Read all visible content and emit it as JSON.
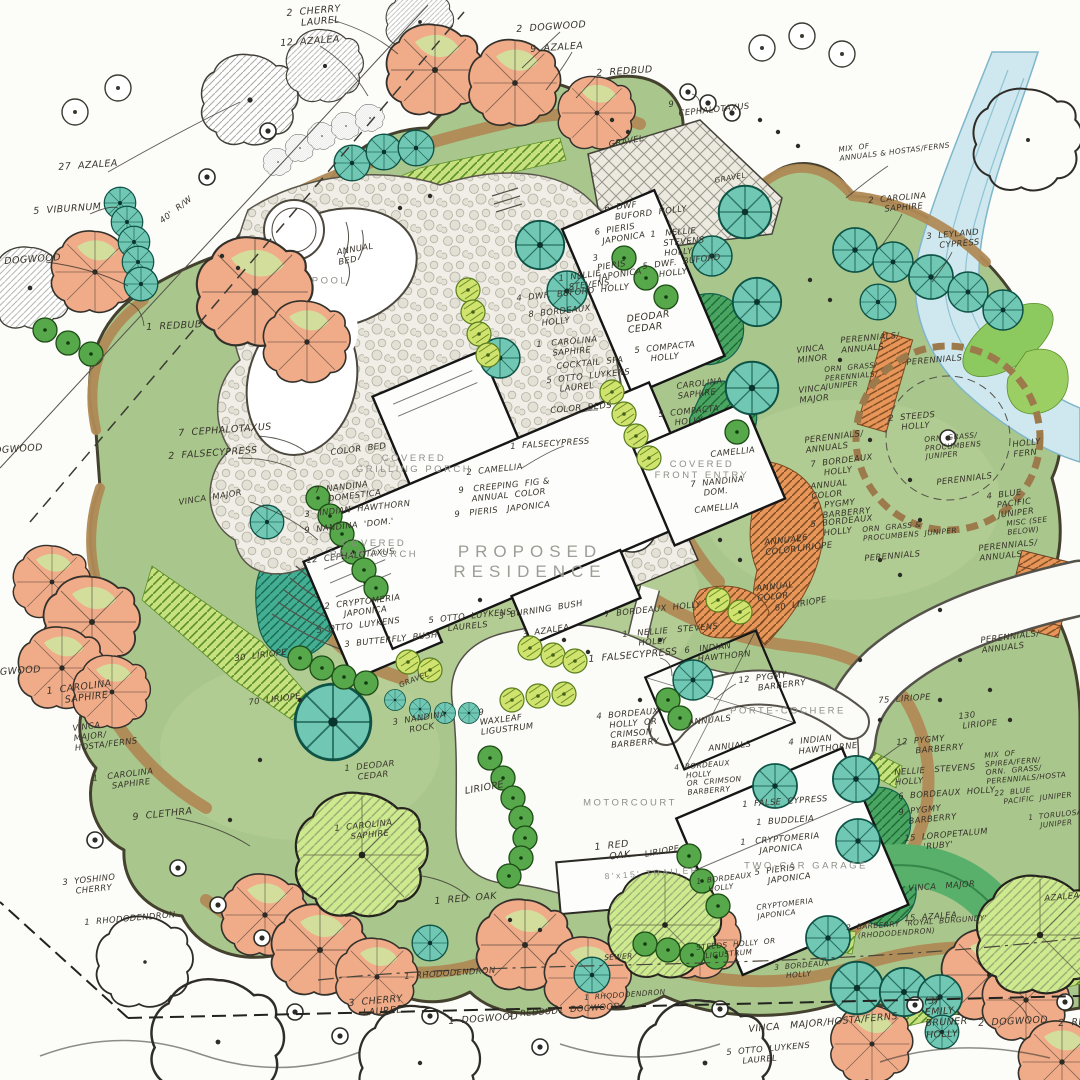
{
  "drawing": {
    "kind": "residential landscape master plan",
    "style": "hand-drawn color rendering"
  },
  "colors": {
    "paper": "#fcfcf9",
    "lawn": "#a9c78d",
    "bed_tan": "#b08a56",
    "evergreen_teal": "#6fc7b4",
    "canopy_salmon": "#f0ab89",
    "shrub_green": "#56a84b",
    "light_green": "#c6e17e",
    "water_blue": "#cfe8ef",
    "pencil": "#37332a",
    "arch_text": "#8f8f88"
  },
  "structure_labels": [
    {
      "t": "POOL",
      "x": 330,
      "y": 281,
      "k": "a"
    },
    {
      "t": "PROPOSED\nRESIDENCE",
      "x": 530,
      "y": 562,
      "k": "A"
    },
    {
      "t": "COVERED\nGRILLING PORCH",
      "x": 414,
      "y": 464,
      "k": "a"
    },
    {
      "t": "COVERED\nREAR PORCH",
      "x": 374,
      "y": 549,
      "k": "a"
    },
    {
      "t": "COVERED\nFRONT ENTRY",
      "x": 702,
      "y": 470,
      "k": "a"
    },
    {
      "t": "MOTORCOURT",
      "x": 630,
      "y": 803,
      "k": "a"
    },
    {
      "t": "PORTE-COCHERE",
      "x": 788,
      "y": 711,
      "k": "a"
    },
    {
      "t": "TWO-CAR GARAGE",
      "x": 806,
      "y": 866,
      "k": "a"
    },
    {
      "t": "8'x15' TRAILER",
      "x": 652,
      "y": 873,
      "k": "a8",
      "r": -4
    }
  ],
  "plant_labels": [
    {
      "t": "2  CHERRY\n    LAUREL",
      "x": 286,
      "y": 8,
      "r": -5
    },
    {
      "t": "12  AZALEA",
      "x": 280,
      "y": 38,
      "r": -4
    },
    {
      "t": "2  DOGWOOD",
      "x": 516,
      "y": 24,
      "r": -4
    },
    {
      "t": "9  AZALEA",
      "x": 530,
      "y": 44,
      "r": -4
    },
    {
      "t": "2  REDBUD",
      "x": 596,
      "y": 68,
      "r": -4
    },
    {
      "t": "9\n   CEPHALOTAXUS",
      "x": 668,
      "y": 100,
      "r": -6,
      "k": "h8"
    },
    {
      "t": "GRAVEL",
      "x": 608,
      "y": 140,
      "r": -10,
      "k": "h8"
    },
    {
      "t": "GRAVEL",
      "x": 714,
      "y": 177,
      "r": -10,
      "k": "h7"
    },
    {
      "t": "MIX  OF\nANNUALS & HOSTAS/FERNS",
      "x": 838,
      "y": 146,
      "r": -7,
      "k": "h7"
    },
    {
      "t": "2  CAROLINA\n     SAPHIRE",
      "x": 868,
      "y": 196,
      "r": -5,
      "k": "h8"
    },
    {
      "t": "3  LEYLAND\n    CYPRESS",
      "x": 926,
      "y": 232,
      "r": -5,
      "k": "h8"
    },
    {
      "t": "27  AZALEA",
      "x": 58,
      "y": 162,
      "r": -4
    },
    {
      "t": "5  VIBURNUM",
      "x": 33,
      "y": 206,
      "r": -4
    },
    {
      "t": "40'  R/W",
      "x": 158,
      "y": 218,
      "r": -38,
      "k": "h8"
    },
    {
      "t": "DOGWOOD",
      "x": 4,
      "y": 256,
      "r": -4
    },
    {
      "t": "1  REDBUD",
      "x": 146,
      "y": 322,
      "r": -3
    },
    {
      "t": "ANNUAL\nBED",
      "x": 336,
      "y": 248,
      "r": -10,
      "k": "h8"
    },
    {
      "t": "6  DWF\n   BUFORD  HOLLY",
      "x": 604,
      "y": 204,
      "r": -7,
      "k": "h8"
    },
    {
      "t": "6  PIERIS\n  JAPONICA",
      "x": 594,
      "y": 228,
      "r": -9,
      "k": "h8"
    },
    {
      "t": "1   NELLIE\n    STEVENS\n    HOLLY",
      "x": 650,
      "y": 230,
      "r": -5,
      "k": "h8"
    },
    {
      "t": "3\n PIERIS\n JAPONICA",
      "x": 592,
      "y": 254,
      "r": -9,
      "k": "h8"
    },
    {
      "t": "5  DWF.  BUFORD\n     HOLLY",
      "x": 642,
      "y": 262,
      "r": -7,
      "k": "h8"
    },
    {
      "t": "1  NELLIE\n   STEVENS",
      "x": 558,
      "y": 274,
      "r": -7,
      "k": "h8"
    },
    {
      "t": "4  DWF.  BUFORD  HOLLY",
      "x": 516,
      "y": 294,
      "r": -6,
      "k": "h8"
    },
    {
      "t": "8  BORDEAUX\n    HOLLY",
      "x": 528,
      "y": 310,
      "r": -6,
      "k": "h8"
    },
    {
      "t": "1   CAROLINA\n     SAPHIRE",
      "x": 536,
      "y": 340,
      "r": -5,
      "k": "h8"
    },
    {
      "t": "COCKTAIL  SPA",
      "x": 556,
      "y": 362,
      "r": -6,
      "k": "h8"
    },
    {
      "t": "5  OTTO  LUYKENS\n    LAUREL",
      "x": 546,
      "y": 376,
      "r": -6,
      "k": "h8"
    },
    {
      "t": "COLOR  BEDS",
      "x": 550,
      "y": 406,
      "r": -5,
      "k": "h8"
    },
    {
      "t": "1  FALSECYPRESS",
      "x": 510,
      "y": 442,
      "r": -4,
      "k": "h8"
    },
    {
      "t": "DEODAR\nCEDAR",
      "x": 626,
      "y": 314,
      "r": -7
    },
    {
      "t": "5  COMPACTA\n     HOLLY",
      "x": 634,
      "y": 346,
      "r": -6,
      "k": "h8"
    },
    {
      "t": "CAROLINA\nSAPHIRE",
      "x": 676,
      "y": 382,
      "r": -7,
      "k": "h8"
    },
    {
      "t": "5  COMPACTA\n     HOLLY",
      "x": 658,
      "y": 410,
      "r": -6,
      "k": "h8"
    },
    {
      "t": "CAMELLIA",
      "x": 710,
      "y": 450,
      "r": -6,
      "k": "h8"
    },
    {
      "t": "7  NANDINA\n    DOM.",
      "x": 690,
      "y": 480,
      "r": -6,
      "k": "h8"
    },
    {
      "t": "CAMELLIA",
      "x": 694,
      "y": 506,
      "r": -6,
      "k": "h8"
    },
    {
      "t": "PERENNIALS/\nANNUALS",
      "x": 804,
      "y": 436,
      "r": -7,
      "k": "h8"
    },
    {
      "t": "7  BORDEAUX\n    HOLLY",
      "x": 810,
      "y": 460,
      "r": -7,
      "k": "h8"
    },
    {
      "t": "ANNUAL\nCOLOR",
      "x": 810,
      "y": 482,
      "r": -6,
      "k": "h8"
    },
    {
      "t": "7  PYGMY\n   BARBERRY",
      "x": 812,
      "y": 502,
      "r": -6,
      "k": "h8"
    },
    {
      "t": "5  BORDEAUX\n    HOLLY",
      "x": 810,
      "y": 520,
      "r": -6,
      "k": "h8"
    },
    {
      "t": "26\nLIRIOPE",
      "x": 796,
      "y": 534,
      "r": -6,
      "k": "h8"
    },
    {
      "t": "ANNUAL\nCOLOR",
      "x": 764,
      "y": 538,
      "r": -6,
      "k": "h8"
    },
    {
      "t": "ANNUAL\nCOLOR",
      "x": 756,
      "y": 584,
      "r": -6,
      "k": "h8"
    },
    {
      "t": "60  LIRIOPE",
      "x": 774,
      "y": 604,
      "r": -10,
      "k": "h8"
    },
    {
      "t": "VINCA\nMINOR",
      "x": 796,
      "y": 346,
      "r": -6,
      "k": "h8"
    },
    {
      "t": "VINCA\nMAJOR",
      "x": 798,
      "y": 386,
      "r": -6,
      "k": "h8"
    },
    {
      "t": "PERENNIALS/\nANNUALS",
      "x": 840,
      "y": 336,
      "r": -5,
      "k": "h8"
    },
    {
      "t": "PERENNIALS",
      "x": 906,
      "y": 358,
      "r": -5,
      "k": "h8"
    },
    {
      "t": "ORN  GRASS/\nPERENNIALS/\nJUNIPER",
      "x": 824,
      "y": 366,
      "r": -5,
      "k": "h7"
    },
    {
      "t": "2  STEEDS\n    HOLLY",
      "x": 888,
      "y": 414,
      "r": -5,
      "k": "h8"
    },
    {
      "t": "ORN  GRASS/\nPROCUMBENS\nJUNIPER",
      "x": 924,
      "y": 436,
      "r": -5,
      "k": "h7"
    },
    {
      "t": "PERENNIALS",
      "x": 936,
      "y": 478,
      "r": -7,
      "k": "h8"
    },
    {
      "t": "HOLLY\nFERN",
      "x": 1012,
      "y": 440,
      "r": -6,
      "k": "h8"
    },
    {
      "t": "4  BLUE\n   PACIFIC\n   JUNIPER",
      "x": 986,
      "y": 492,
      "r": -7,
      "k": "h8"
    },
    {
      "t": "MISC (SEE\nBELOW)",
      "x": 1006,
      "y": 520,
      "r": -6,
      "k": "h7"
    },
    {
      "t": "PERENNIALS/\nANNUALS",
      "x": 978,
      "y": 544,
      "r": -6,
      "k": "h8"
    },
    {
      "t": "ORN  GRASS &\nPROCUMBENS  JUNIPER",
      "x": 862,
      "y": 526,
      "r": -5,
      "k": "h7"
    },
    {
      "t": "PERENNIALS",
      "x": 864,
      "y": 554,
      "r": -5,
      "k": "h8"
    },
    {
      "t": "7  CEPHALOTAXUS",
      "x": 178,
      "y": 428,
      "r": -4
    },
    {
      "t": "2  FALSECYPRESS",
      "x": 168,
      "y": 451,
      "r": -4
    },
    {
      "t": "VINCA  MAJOR",
      "x": 178,
      "y": 498,
      "r": -9,
      "k": "h8"
    },
    {
      "t": "COLOR  BED",
      "x": 330,
      "y": 448,
      "r": -7,
      "k": "h8"
    },
    {
      "t": "7  NANDINA\n    DOMESTICA",
      "x": 314,
      "y": 486,
      "r": -7,
      "k": "h8"
    },
    {
      "t": "3   INDIAN  HAWTHORN",
      "x": 304,
      "y": 510,
      "r": -6,
      "k": "h8"
    },
    {
      "t": "9  NANDINA  'DOM.'",
      "x": 304,
      "y": 526,
      "r": -6,
      "k": "h8"
    },
    {
      "t": "12  CEPHALOTAXUS",
      "x": 306,
      "y": 556,
      "r": -6,
      "k": "h8"
    },
    {
      "t": "2  CAMELLIA",
      "x": 466,
      "y": 468,
      "r": -6,
      "k": "h8"
    },
    {
      "t": "9   CREEPING  FIG &\n    ANNUAL  COLOR",
      "x": 458,
      "y": 486,
      "r": -6,
      "k": "h8"
    },
    {
      "t": "9   PIERIS   JAPONICA",
      "x": 454,
      "y": 510,
      "r": -6,
      "k": "h8"
    },
    {
      "t": "2  CRYPTOMERIA\n      JAPONICA",
      "x": 324,
      "y": 602,
      "r": -7,
      "k": "h8"
    },
    {
      "t": "5  OTTO  LUYKENS",
      "x": 316,
      "y": 626,
      "r": -7,
      "k": "h8"
    },
    {
      "t": "3  BUTTERFLY  BUSH",
      "x": 344,
      "y": 640,
      "r": -6,
      "k": "h8"
    },
    {
      "t": "5  OTTO  LUYKENS\n      LAURELS",
      "x": 428,
      "y": 616,
      "r": -6,
      "k": "h8"
    },
    {
      "t": "3  BURNING  BUSH",
      "x": 498,
      "y": 612,
      "r": -9,
      "k": "h8"
    },
    {
      "t": "3  AZALEA",
      "x": 522,
      "y": 630,
      "r": -9,
      "k": "h8"
    },
    {
      "t": "GRAVEL",
      "x": 398,
      "y": 682,
      "r": -22,
      "k": "h7"
    },
    {
      "t": "3  NANDINA\n     ROCK",
      "x": 392,
      "y": 718,
      "r": -9,
      "k": "h8"
    },
    {
      "t": "9\nWAXLEAF\nLIGUSTRUM",
      "x": 478,
      "y": 708,
      "r": -7,
      "k": "h8"
    },
    {
      "t": "30  LIRIOPE",
      "x": 234,
      "y": 654,
      "r": -7,
      "k": "h8"
    },
    {
      "t": "70  LIRIOPE",
      "x": 248,
      "y": 698,
      "r": -7,
      "k": "h8"
    },
    {
      "t": "1  CAROLINA\n     SAPHIRE",
      "x": 46,
      "y": 686,
      "r": -7
    },
    {
      "t": "VINCA\nMAJOR/\nHOSTA/FERNS",
      "x": 72,
      "y": 724,
      "r": -7,
      "k": "h8"
    },
    {
      "t": "1   CAROLINA\n      SAPHIRE",
      "x": 92,
      "y": 774,
      "r": -7,
      "k": "h8"
    },
    {
      "t": "9  CLETHRA",
      "x": 132,
      "y": 812,
      "r": -6
    },
    {
      "t": "3  YOSHINO\n    CHERRY",
      "x": 62,
      "y": 878,
      "r": -6,
      "k": "h8"
    },
    {
      "t": "1  RHODODENDRON",
      "x": 84,
      "y": 918,
      "r": -5,
      "k": "h8"
    },
    {
      "t": "1  DEODAR\n    CEDAR",
      "x": 344,
      "y": 764,
      "r": -6,
      "k": "h8"
    },
    {
      "t": "1  CAROLINA\n     SAPHIRE",
      "x": 334,
      "y": 824,
      "r": -6,
      "k": "h8"
    },
    {
      "t": "LIRIOPE",
      "x": 464,
      "y": 786,
      "r": -10
    },
    {
      "t": "1  RED  OAK",
      "x": 434,
      "y": 896,
      "r": -5
    },
    {
      "t": "1  RED\n    OAK",
      "x": 594,
      "y": 842,
      "r": -6
    },
    {
      "t": "LIRIOPE",
      "x": 644,
      "y": 850,
      "r": -10,
      "k": "h8"
    },
    {
      "t": "7  BORDEAUX  HOLLY",
      "x": 604,
      "y": 610,
      "r": -6,
      "k": "h8"
    },
    {
      "t": "1   NELLIE   STEVENS\n     HOLLY",
      "x": 622,
      "y": 630,
      "r": -5,
      "k": "h8"
    },
    {
      "t": "1  FALSECYPRESS",
      "x": 588,
      "y": 654,
      "r": -5
    },
    {
      "t": "6   INDIAN\n    HAWTHORN",
      "x": 684,
      "y": 646,
      "r": -6,
      "k": "h8"
    },
    {
      "t": "12  PYGMY\n      BARBERRY",
      "x": 738,
      "y": 676,
      "r": -7,
      "k": "h8"
    },
    {
      "t": "4  BORDEAUX\n    HOLLY  OR\n    CRIMSON\n    BARBERRY",
      "x": 596,
      "y": 712,
      "r": -5,
      "k": "h8"
    },
    {
      "t": "ANNUALS",
      "x": 688,
      "y": 718,
      "r": -6,
      "k": "h8"
    },
    {
      "t": "ANNUALS",
      "x": 708,
      "y": 744,
      "r": -6,
      "k": "h8"
    },
    {
      "t": "4  INDIAN\n   HAWTHORNE",
      "x": 788,
      "y": 738,
      "r": -6,
      "k": "h8"
    },
    {
      "t": "4  BORDEAUX\n    HOLLY\n    OR  CRIMSON\n    BARBERRY",
      "x": 674,
      "y": 764,
      "r": -5,
      "k": "h7"
    },
    {
      "t": "1  FALSE  CYPRESS",
      "x": 742,
      "y": 800,
      "r": -4,
      "k": "h8"
    },
    {
      "t": "1  BUDDLEIA",
      "x": 756,
      "y": 818,
      "r": -4,
      "k": "h8"
    },
    {
      "t": "1   CRYPTOMERIA\n      JAPONICA",
      "x": 740,
      "y": 838,
      "r": -5,
      "k": "h8"
    },
    {
      "t": "5  PIERIS\n    JAPONICA",
      "x": 754,
      "y": 868,
      "r": -7,
      "k": "h8"
    },
    {
      "t": "1  BORDEAUX\n    HOLLY",
      "x": 696,
      "y": 878,
      "r": -7,
      "k": "h7"
    },
    {
      "t": "CRYPTOMERIA\nJAPONICA",
      "x": 756,
      "y": 904,
      "r": -7,
      "k": "h7"
    },
    {
      "t": "12  PYGMY\n      BARBERRY",
      "x": 896,
      "y": 738,
      "r": -5,
      "k": "h8"
    },
    {
      "t": "NELLIE   STEVENS\nHOLLY",
      "x": 894,
      "y": 768,
      "r": -4,
      "k": "h8"
    },
    {
      "t": "6  BORDEAUX  HOLLY",
      "x": 898,
      "y": 792,
      "r": -4,
      "k": "h8"
    },
    {
      "t": "9  PYGMY\n   BARBERRY",
      "x": 898,
      "y": 808,
      "r": -6,
      "k": "h8"
    },
    {
      "t": "15  LOROPETALUM\n      'RUBY'",
      "x": 904,
      "y": 834,
      "r": -5,
      "k": "h8"
    },
    {
      "t": "VINCA   MAJOR",
      "x": 908,
      "y": 884,
      "r": -4,
      "k": "h8"
    },
    {
      "t": "15  AZALEA",
      "x": 904,
      "y": 914,
      "r": -4,
      "k": "h8"
    },
    {
      "t": "2  BARBERRY  'ROYAL  BURGUNDY'\n    (RHODODENDRON)",
      "x": 846,
      "y": 924,
      "r": -4,
      "k": "h7"
    },
    {
      "t": "75  LIRIOPE",
      "x": 878,
      "y": 696,
      "r": -4,
      "k": "h8"
    },
    {
      "t": "130\n LIRIOPE",
      "x": 958,
      "y": 712,
      "r": -6,
      "k": "h8"
    },
    {
      "t": "PERENNIALS/\nANNUALS",
      "x": 980,
      "y": 636,
      "r": -7,
      "k": "h8"
    },
    {
      "t": "MIX  OF\nSPIREA/FERN/\nORN.  GRASS/\nPERENNIALS/HOSTA",
      "x": 984,
      "y": 752,
      "r": -5,
      "k": "h7"
    },
    {
      "t": "22  BLUE\n   PACIFIC  JUNIPER",
      "x": 994,
      "y": 790,
      "r": -6,
      "k": "h7"
    },
    {
      "t": "1  TORULOSA\n    JUNIPER",
      "x": 1028,
      "y": 814,
      "r": -6,
      "k": "h7"
    },
    {
      "t": "AZALEA",
      "x": 1044,
      "y": 894,
      "r": -5,
      "k": "h8"
    },
    {
      "t": "3  CHERRY\n    LAUREL",
      "x": 348,
      "y": 998,
      "r": -5
    },
    {
      "t": "1  RHODODENDRON",
      "x": 404,
      "y": 972,
      "r": -4,
      "k": "h8"
    },
    {
      "t": "1  DOGWOOD",
      "x": 448,
      "y": 1016,
      "r": -4
    },
    {
      "t": "1  REDBUD",
      "x": 508,
      "y": 1010,
      "r": -4,
      "k": "h8"
    },
    {
      "t": "1  DOGWOOD",
      "x": 558,
      "y": 1006,
      "r": -4,
      "k": "h8"
    },
    {
      "t": "1  RHODODENDRON",
      "x": 584,
      "y": 994,
      "r": -4,
      "k": "h7"
    },
    {
      "t": "SEWER",
      "x": 604,
      "y": 954,
      "r": -3,
      "k": "h7"
    },
    {
      "t": "STEEDS  HOLLY  OR\n   LIGUSTRUM",
      "x": 696,
      "y": 944,
      "r": -5,
      "k": "h7"
    },
    {
      "t": "3  BORDEAUX\n    HOLLY",
      "x": 774,
      "y": 964,
      "r": -5,
      "k": "h7"
    },
    {
      "t": "VINCA   MAJOR/HOSTA/FERNS",
      "x": 748,
      "y": 1024,
      "r": -5
    },
    {
      "t": "5  OTTO  LUYKENS\n     LAUREL",
      "x": 726,
      "y": 1048,
      "r": -5,
      "k": "h8"
    },
    {
      "t": "(3)\nEMILY\nBRUNER\nHOLLY",
      "x": 924,
      "y": 996,
      "r": -3
    },
    {
      "t": "2  DOGWOOD",
      "x": 978,
      "y": 1018,
      "r": -3
    },
    {
      "t": "2  REDBUD",
      "x": 1058,
      "y": 1018,
      "r": -3
    },
    {
      "t": "DOGWOOD",
      "x": -16,
      "y": 668,
      "r": -4
    },
    {
      "t": "DOGWOOD",
      "x": -14,
      "y": 446,
      "r": -4
    }
  ]
}
